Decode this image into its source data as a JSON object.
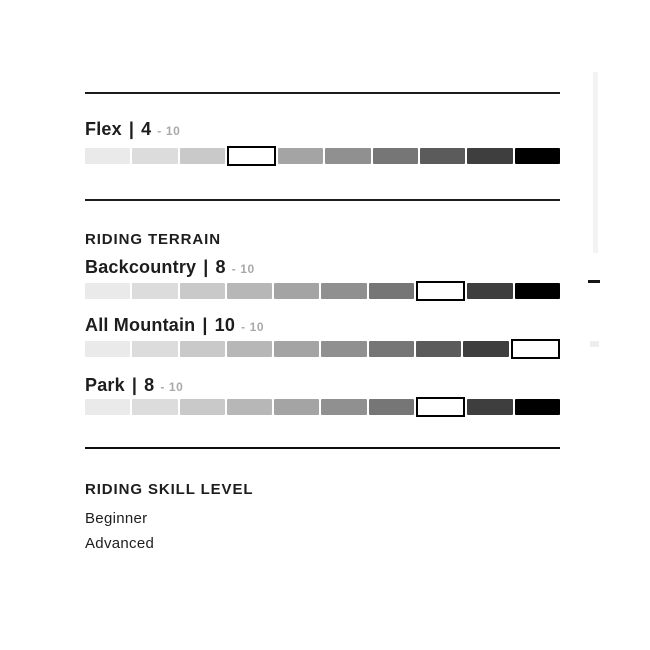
{
  "sections": {
    "flex": {
      "label": "Flex"
    },
    "terrain": {
      "heading": "RIDING TERRAIN",
      "rows": [
        {
          "label": "Backcountry"
        },
        {
          "label": "All Mountain"
        },
        {
          "label": "Park"
        }
      ]
    },
    "skill": {
      "heading": "RIDING SKILL LEVEL",
      "items": [
        {
          "label": "Beginner"
        },
        {
          "label": "Advanced"
        }
      ]
    }
  },
  "scale": {
    "separator": "|",
    "suffix": "- 10"
  },
  "chart_data": {
    "type": "rating-bars",
    "max": 10,
    "bars": [
      {
        "name": "Flex",
        "value": 4
      },
      {
        "name": "Backcountry",
        "value": 8
      },
      {
        "name": "All Mountain",
        "value": 10
      },
      {
        "name": "Park",
        "value": 8
      }
    ],
    "segment_colors": [
      "#eaeaea",
      "#dcdcdc",
      "#c9c9c9",
      "#b7b7b7",
      "#a4a4a4",
      "#909090",
      "#767676",
      "#5b5b5b",
      "#3e3e3e",
      "#000000"
    ],
    "highlight": {
      "fill": "#ffffff",
      "border": "#000000"
    },
    "text_color": "#1d1d1d",
    "suffix_color": "#a9a9a9"
  }
}
